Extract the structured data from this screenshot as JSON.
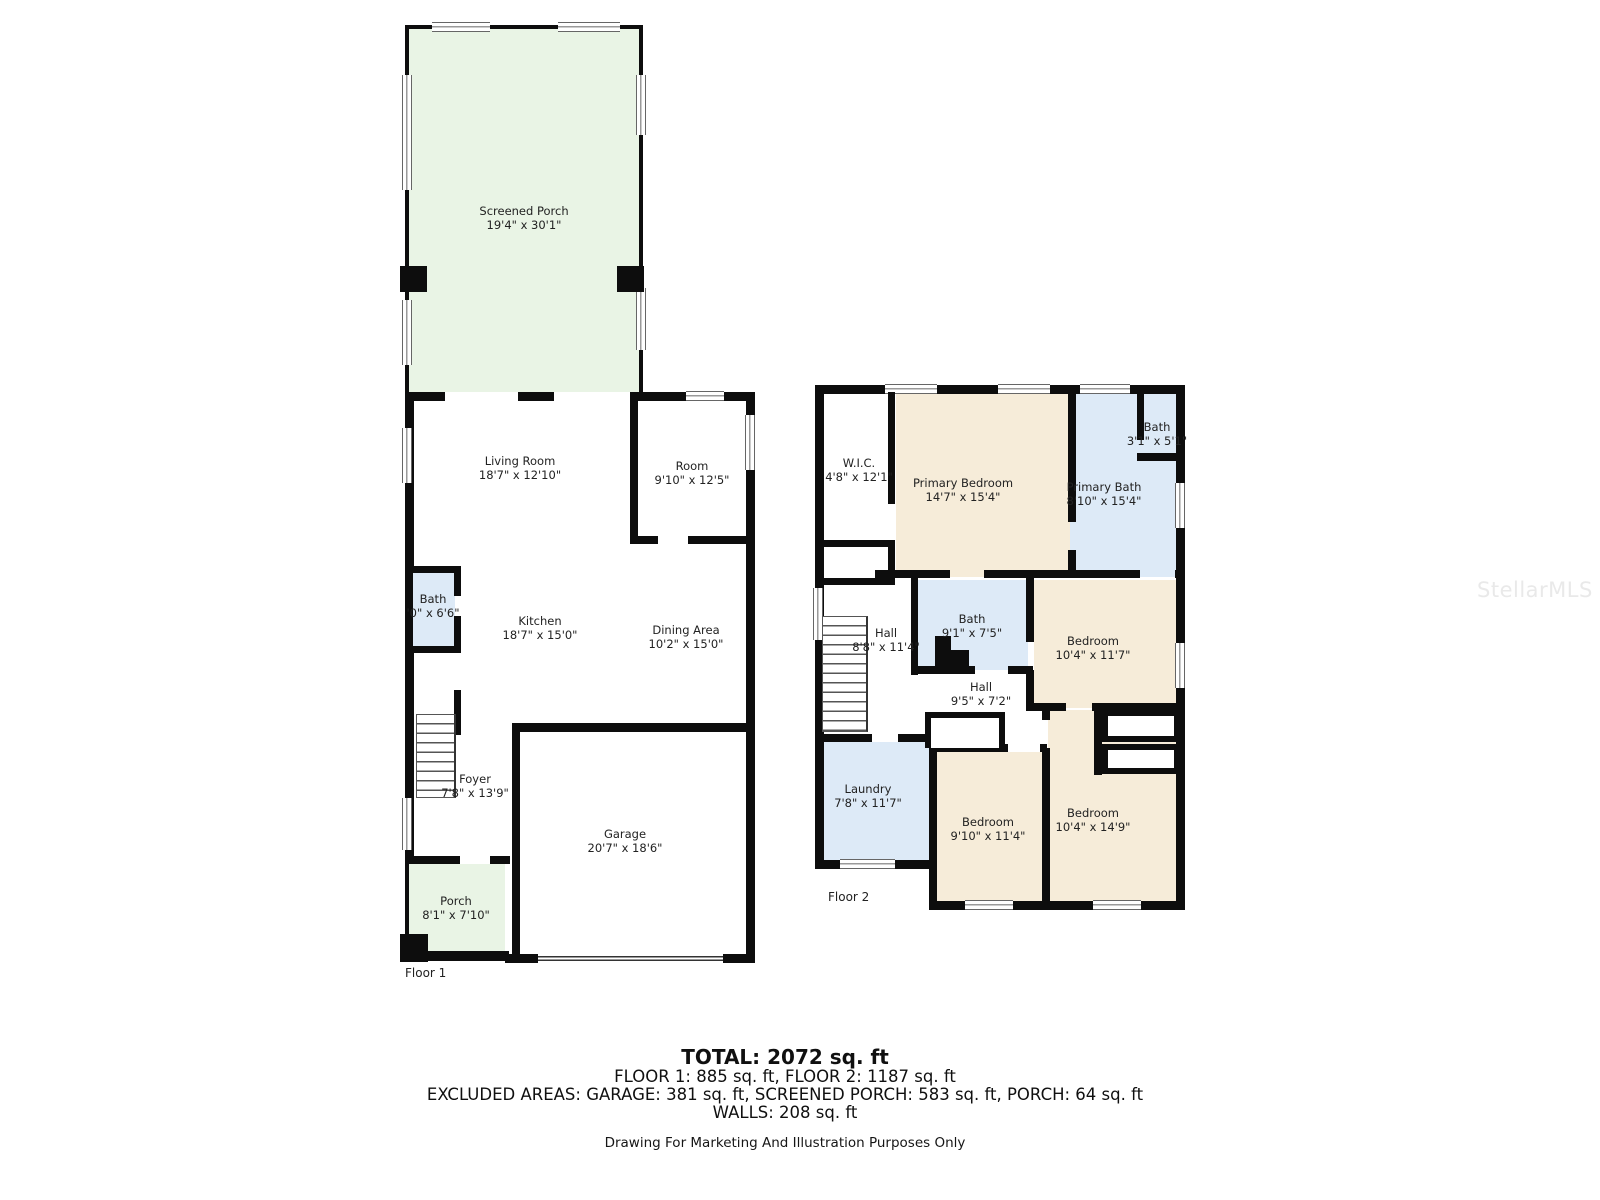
{
  "watermark": "StellarMLS",
  "colors": {
    "porch_green": "#e9f4e5",
    "bedroom_beige": "#f6ecd9",
    "bath_blue": "#ddeaf7",
    "wall_black": "#0d0d0d"
  },
  "floor1": {
    "tag": "Floor 1",
    "rooms": {
      "screened_porch": {
        "name": "Screened Porch",
        "dims": "19'4\" x 30'1\""
      },
      "living_room": {
        "name": "Living Room",
        "dims": "18'7\" x 12'10\""
      },
      "room": {
        "name": "Room",
        "dims": "9'10\" x 12'5\""
      },
      "bath": {
        "name": "Bath",
        "dims": "'0\" x 6'6\""
      },
      "kitchen": {
        "name": "Kitchen",
        "dims": "18'7\" x 15'0\""
      },
      "dining": {
        "name": "Dining Area",
        "dims": "10'2\" x 15'0\""
      },
      "foyer": {
        "name": "Foyer",
        "dims": "7'8\" x 13'9\""
      },
      "garage": {
        "name": "Garage",
        "dims": "20'7\" x 18'6\""
      },
      "porch": {
        "name": "Porch",
        "dims": "8'1\" x 7'10\""
      }
    }
  },
  "floor2": {
    "tag": "Floor 2",
    "rooms": {
      "wic": {
        "name": "W.I.C.",
        "dims": "4'8\" x 12'1\""
      },
      "primary_bedroom": {
        "name": "Primary Bedroom",
        "dims": "14'7\" x 15'4\""
      },
      "bath_small": {
        "name": "Bath",
        "dims": "3'1\" x 5'1\""
      },
      "primary_bath": {
        "name": "Primary Bath",
        "dims": "8'10\" x 15'4\""
      },
      "hall_upper": {
        "name": "Hall",
        "dims": "8'8\" x 11'4\""
      },
      "bath_mid": {
        "name": "Bath",
        "dims": "9'1\" x 7'5\""
      },
      "bedroom_ne": {
        "name": "Bedroom",
        "dims": "10'4\" x 11'7\""
      },
      "hall_lower": {
        "name": "Hall",
        "dims": "9'5\" x 7'2\""
      },
      "laundry": {
        "name": "Laundry",
        "dims": "7'8\" x 11'7\""
      },
      "bedroom_s": {
        "name": "Bedroom",
        "dims": "9'10\" x 11'4\""
      },
      "bedroom_se": {
        "name": "Bedroom",
        "dims": "10'4\" x 14'9\""
      }
    }
  },
  "summary": {
    "total": "TOTAL: 2072 sq. ft",
    "floors": "FLOOR 1: 885 sq. ft, FLOOR 2: 1187 sq. ft",
    "excluded": "EXCLUDED AREAS: GARAGE: 381 sq. ft, SCREENED PORCH: 583 sq. ft, PORCH: 64 sq. ft",
    "walls": "WALLS: 208 sq. ft",
    "disclaimer": "Drawing For Marketing And Illustration Purposes Only"
  }
}
